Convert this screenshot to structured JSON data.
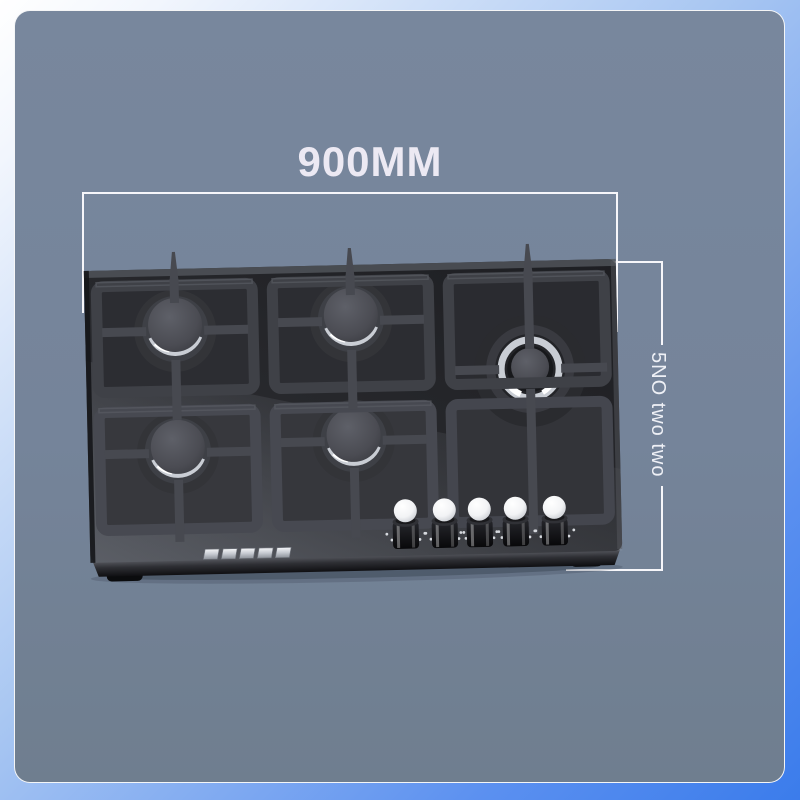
{
  "annotations": {
    "width_label": "900MM",
    "side_label": "5NO two two",
    "line_color": "#f6f6fa",
    "label_color": "#ece9f3"
  },
  "product": {
    "burner_count": 5,
    "knob_count": 5,
    "logo_glyph_count": 5
  },
  "colors": {
    "canvas_top": "#ffffff",
    "canvas_bottom": "#3b7ceb",
    "card_top": "#78879d",
    "card_bottom": "#6f7e8f",
    "hob_glass": "#26272b",
    "grate": "#404249",
    "chrome_ring": "#d4d8de",
    "knob_top": "#ffffff"
  }
}
